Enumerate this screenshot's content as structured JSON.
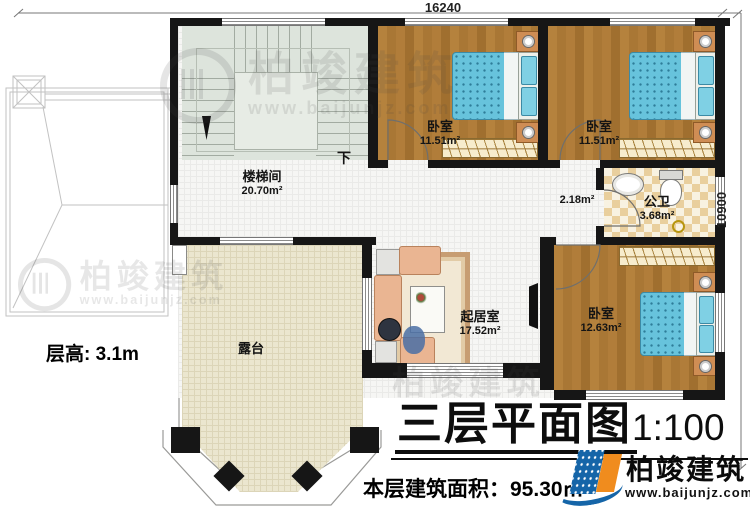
{
  "dims": {
    "width": "16240",
    "height": "10900"
  },
  "rooms": {
    "stairwell": {
      "name": "楼梯间",
      "area": "20.70m²"
    },
    "bedroom1": {
      "name": "卧室",
      "area": "11.51m²"
    },
    "bedroom2": {
      "name": "卧室",
      "area": "11.51m²"
    },
    "bathroom": {
      "name": "公卫",
      "area": "3.68m²"
    },
    "hall_nook": {
      "area": "2.18m²"
    },
    "bedroom3": {
      "name": "卧室",
      "area": "12.63m²"
    },
    "living": {
      "name": "起居室",
      "area": "17.52m²"
    },
    "terrace": {
      "name": "露台"
    }
  },
  "labels": {
    "stair_down": "下",
    "floor_height": "层高: 3.1m"
  },
  "title": {
    "main": "三层平面图",
    "scale": "1:100",
    "area_line": "本层建筑面积：95.30㎡"
  },
  "brand": {
    "name": "柏竣建筑",
    "site": "www.baijunjz.com、"
  },
  "watermark": {
    "name": "柏竣建筑",
    "site": "www.baijunjz.com"
  }
}
